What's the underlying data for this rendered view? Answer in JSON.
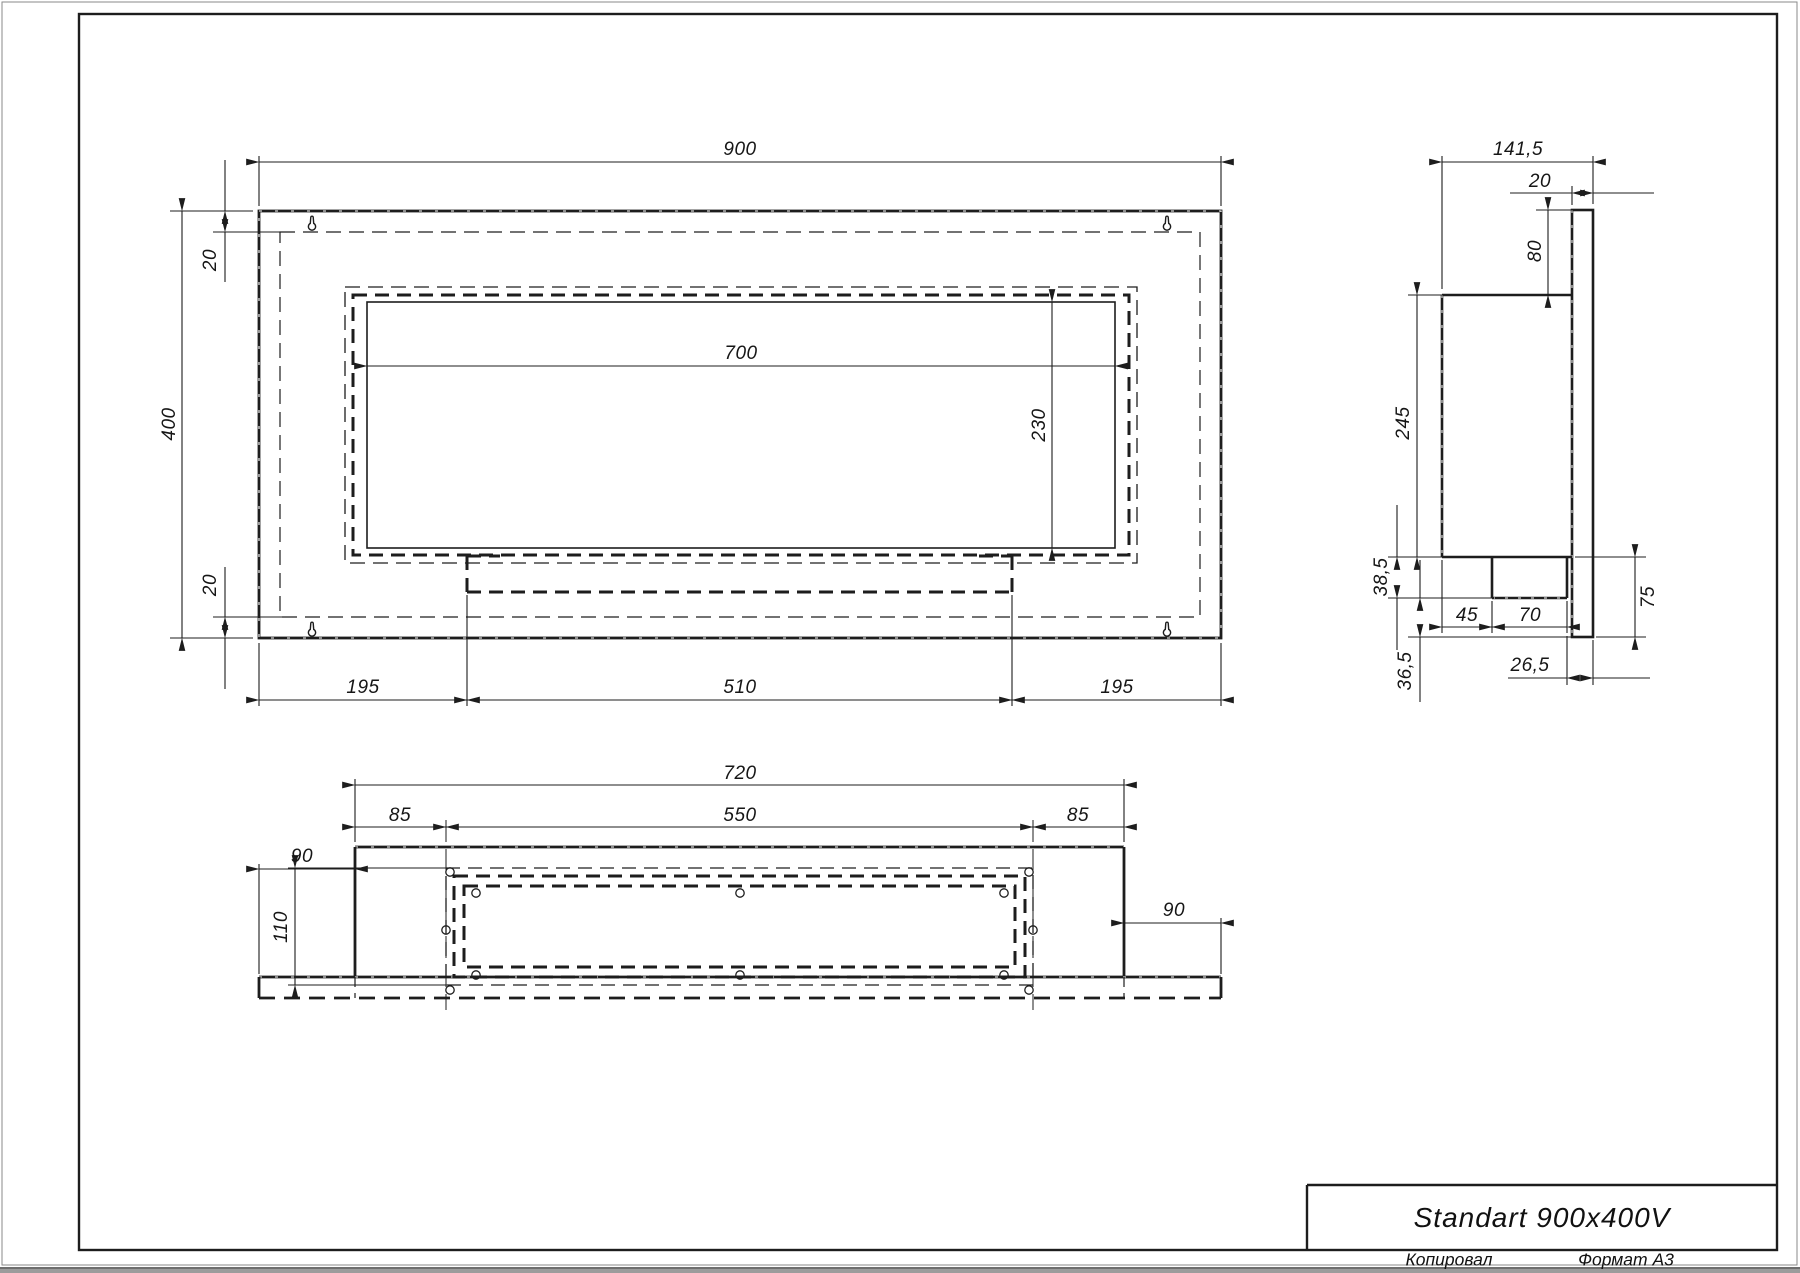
{
  "colors": {
    "line": "#1d1d1d",
    "paper": "#ffffff",
    "background": "#9c9c9c"
  },
  "title_block": {
    "product_name": "Standart 900x400V"
  },
  "footer": {
    "copied": "Копировал",
    "format": "Формат А3"
  },
  "front": {
    "w": "900",
    "h": "400",
    "inset_top": "20",
    "inset_bottom": "20",
    "opening_w": "700",
    "opening_h": "230",
    "left": "195",
    "center": "510",
    "right": "195"
  },
  "side": {
    "depth": "141,5",
    "panel": "20",
    "top_offset": "80",
    "body_h": "245",
    "tray_h": "38,5",
    "tray_off": "45",
    "tray_w": "70",
    "panel_drop": "75",
    "tray_gap": "26,5",
    "drop_gap": "36,5"
  },
  "bottom": {
    "w": "720",
    "m_left": "85",
    "frame_w": "550",
    "m_right": "85",
    "flange_left": "90",
    "flange_right": "90",
    "frame_d": "110"
  }
}
